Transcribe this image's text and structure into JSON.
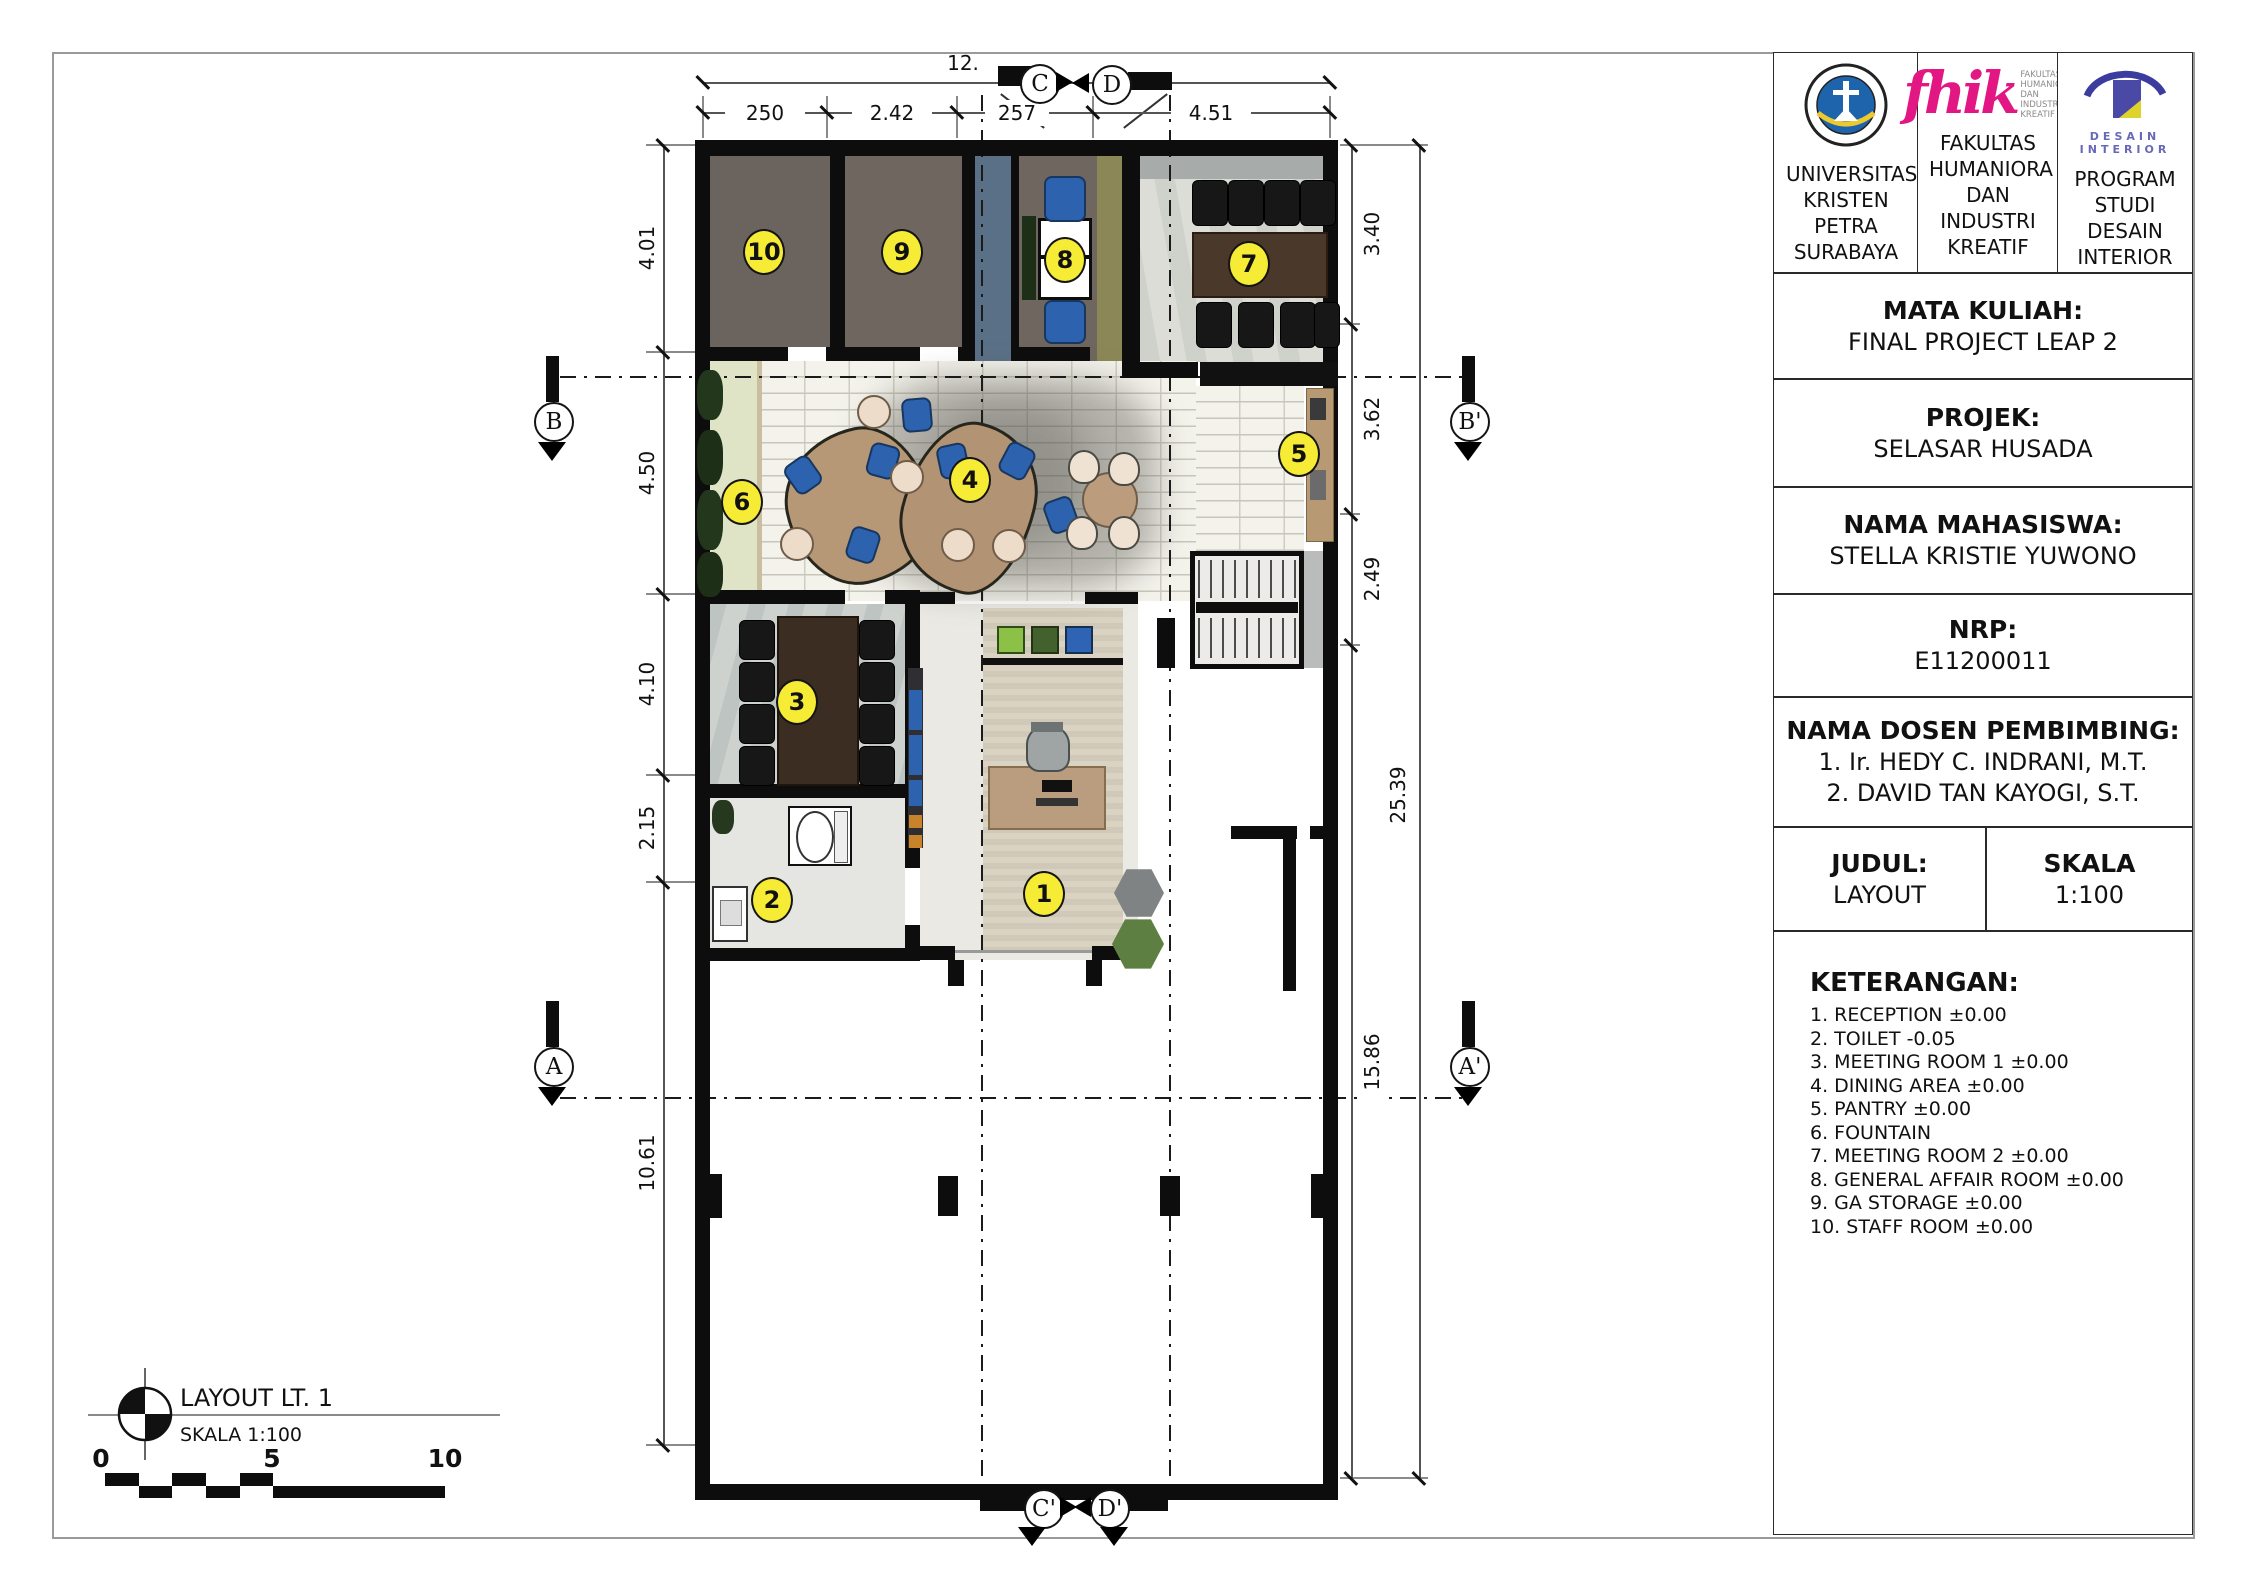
{
  "tb": {
    "inst": [
      {
        "name": "UNIVERSITAS KRISTEN PETRA SURABAYA"
      },
      {
        "name": "FAKULTAS HUMANIORA DAN INDUSTRI KREATIF",
        "glyph": "fhik",
        "caption": "FAKULTAS\nHUMANIORA\nDAN INDUSTRI\nKREATIF"
      },
      {
        "name": "PROGRAM STUDI DESAIN INTERIOR",
        "caption": "DESAIN\nINTERIOR"
      }
    ],
    "fields": [
      {
        "label": "MATA KULIAH:",
        "value": "FINAL PROJECT LEAP 2"
      },
      {
        "label": "PROJEK:",
        "value": "SELASAR HUSADA"
      },
      {
        "label": "NAMA MAHASISWA:",
        "value": "STELLA KRISTIE YUWONO"
      },
      {
        "label": "NRP:",
        "value": "E11200011"
      },
      {
        "label": "NAMA DOSEN PEMBIMBING:",
        "value": "1. Ir. HEDY C. INDRANI, M.T.\n2. DAVID TAN KAYOGI, S.T."
      }
    ],
    "judul_label": "JUDUL:",
    "judul_value": "LAYOUT",
    "skala_label": "SKALA",
    "skala_value": "1:100",
    "ket_title": "KETERANGAN:",
    "ket": [
      "1. RECEPTION ±0.00",
      "2. TOILET -0.05",
      "3. MEETING ROOM 1 ±0.00",
      "4. DINING AREA ±0.00",
      "5. PANTRY ±0.00",
      "6. FOUNTAIN",
      "7. MEETING ROOM 2 ±0.00",
      "8. GENERAL AFFAIR ROOM ±0.00",
      "9. GA STORAGE ±0.00",
      "10. STAFF ROOM ±0.00"
    ]
  },
  "plan": {
    "rooms": [
      "1",
      "2",
      "3",
      "4",
      "5",
      "6",
      "7",
      "8",
      "9",
      "10"
    ],
    "grid": {
      "c": "C",
      "d": "D",
      "c2": "C'",
      "d2": "D'",
      "b": "B",
      "b2": "B'",
      "a": "A",
      "a2": "A'"
    },
    "dims": {
      "top": [
        "250",
        "2.42",
        "257",
        "4.51"
      ],
      "top_overall": "12.",
      "left": [
        "4.01",
        "4.50",
        "4.10",
        "2.15",
        "10.61"
      ],
      "right": [
        "3.40",
        "3.62",
        "2.49",
        "25.39",
        "15.86"
      ]
    },
    "legend": {
      "title": "LAYOUT LT. 1",
      "scale": "SKALA 1:100",
      "bar": [
        "0",
        "5",
        "10"
      ]
    }
  },
  "colors": {
    "bubble_yellow": "#f6ec35",
    "wall_black": "#0d0d0d",
    "petra_blue": "#1d64ad",
    "fhik_pink": "#e31783",
    "di_purple": "#4a49a5",
    "di_yellow": "#ded32b"
  }
}
